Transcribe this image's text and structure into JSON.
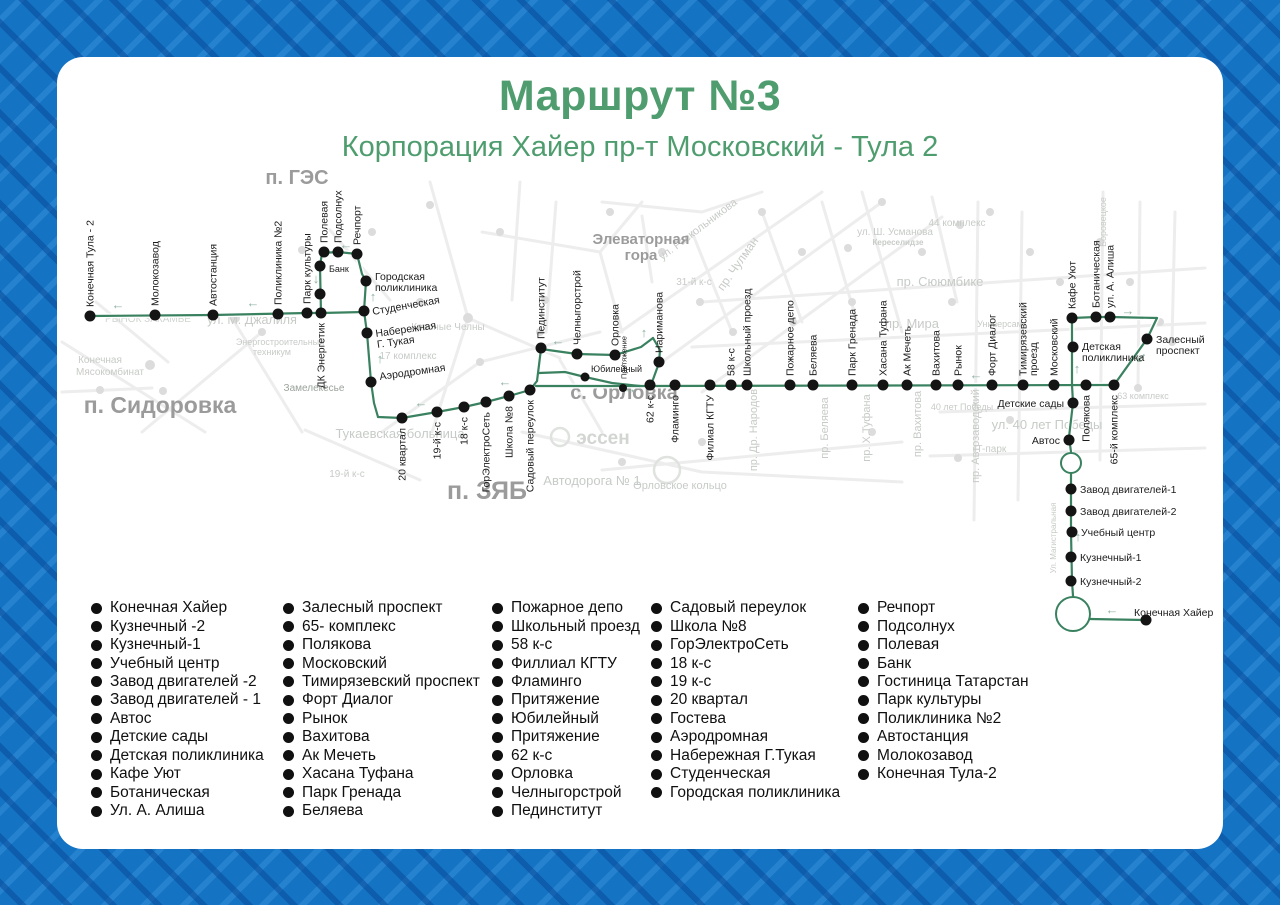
{
  "title": "Маршрут №3",
  "subtitle": "Корпорация Хайер пр-т Московский - Тула 2",
  "colors": {
    "accent_green": "#4f9d6f",
    "route_green": "#3a8160",
    "arrow_green": "#8fb3a1",
    "stop_dot": "#141414",
    "stop_label": "#1c1c1c",
    "area_gray": "#9b9b9b",
    "faint_gray": "#c7cbc7",
    "road_gray": "#ededed",
    "border_blue": "#1573c4",
    "card_bg": "#ffffff",
    "legend_text": "#101010"
  },
  "map": {
    "area_labels": [
      {
        "t": "п. ГЭС",
        "x": 297,
        "y": 184,
        "s": 20
      },
      {
        "t": "п. Сидоровка",
        "x": 160,
        "y": 413,
        "s": 23
      },
      {
        "t": "п. ЗЯБ",
        "x": 487,
        "y": 499,
        "s": 25
      },
      {
        "t": "с. Орловка",
        "x": 624,
        "y": 399,
        "s": 20
      },
      {
        "t": "Элеваторная",
        "x": 641,
        "y": 244,
        "s": 15
      },
      {
        "t": "гора",
        "x": 641,
        "y": 260,
        "s": 15
      }
    ],
    "bg_labels": [
      {
        "t": "РЫНОК ЗАКАМЬЕ",
        "x": 148,
        "y": 322,
        "s": 10,
        "c": "#d0d4d0"
      },
      {
        "t": "ул. М. Джалиля",
        "x": 252,
        "y": 324,
        "s": 12.5
      },
      {
        "t": "Конечная",
        "x": 100,
        "y": 363,
        "s": 10
      },
      {
        "t": "Мясокомбинат",
        "x": 110,
        "y": 375,
        "s": 10
      },
      {
        "t": "Энергостроительный",
        "x": 280,
        "y": 345,
        "s": 9
      },
      {
        "t": "техникум",
        "x": 272,
        "y": 355,
        "s": 9
      },
      {
        "t": "Замелекесье",
        "x": 314,
        "y": 391,
        "s": 10,
        "c": "#9aa29a"
      },
      {
        "t": "17 комплекс",
        "x": 408,
        "y": 359,
        "s": 10
      },
      {
        "t": "Красные Челны",
        "x": 448,
        "y": 330,
        "s": 10
      },
      {
        "t": "Тукаевская больница",
        "x": 400,
        "y": 438,
        "s": 13
      },
      {
        "t": "19-й к-с",
        "x": 347,
        "y": 477,
        "s": 10
      },
      {
        "t": "Автодорога № 1",
        "x": 592,
        "y": 485,
        "s": 13
      },
      {
        "t": "Орловское кольцо",
        "x": 680,
        "y": 489,
        "s": 11
      },
      {
        "t": "эссен",
        "x": 603,
        "y": 444,
        "s": 19,
        "c": "#d2d5d2",
        "b": 1
      },
      {
        "t": "31-й к-с",
        "x": 694,
        "y": 285,
        "s": 10
      },
      {
        "t": "ул. Раскольникова",
        "x": 700,
        "y": 232,
        "s": 11,
        "rot": -37
      },
      {
        "t": "пр. Чулман",
        "x": 741,
        "y": 266,
        "s": 12,
        "rot": -55
      },
      {
        "t": "ул. Ш. Усманова",
        "x": 895,
        "y": 235,
        "s": 10
      },
      {
        "t": "Кереселидзе",
        "x": 898,
        "y": 245,
        "s": 8,
        "b": 1
      },
      {
        "t": "44 комплекс",
        "x": 957,
        "y": 226,
        "s": 10
      },
      {
        "t": "пр. Сююмбике",
        "x": 940,
        "y": 286,
        "s": 13
      },
      {
        "t": "пр. Мира",
        "x": 912,
        "y": 328,
        "s": 13
      },
      {
        "t": "Боровецкое",
        "x": 1106,
        "y": 222,
        "s": 9,
        "vert": 1
      },
      {
        "t": "пр. Др. Народов",
        "x": 757,
        "y": 430,
        "s": 11,
        "vert": 1
      },
      {
        "t": "пр. Беляева",
        "x": 828,
        "y": 428,
        "s": 11,
        "vert": 1
      },
      {
        "t": "пр. Х.Туфана",
        "x": 870,
        "y": 428,
        "s": 11,
        "vert": 1
      },
      {
        "t": "пр. Вахитова",
        "x": 921,
        "y": 424,
        "s": 11,
        "vert": 1
      },
      {
        "t": "пр. Автозаводский",
        "x": 979,
        "y": 436,
        "s": 11,
        "vert": 1
      },
      {
        "t": "ул. 40 лет Победы",
        "x": 1047,
        "y": 429,
        "s": 13
      },
      {
        "t": "40 лет Победы",
        "x": 962,
        "y": 410,
        "s": 9
      },
      {
        "t": "IT-парк",
        "x": 990,
        "y": 452,
        "s": 10
      },
      {
        "t": "Универсам",
        "x": 1000,
        "y": 327,
        "s": 9
      },
      {
        "t": "63 комплекс",
        "x": 1143,
        "y": 399,
        "s": 9
      },
      {
        "t": "Ул. Магистральная",
        "x": 1056,
        "y": 538,
        "s": 8,
        "vert": 1
      }
    ],
    "route_lines": [
      [
        [
          90,
          316
        ],
        [
          213,
          315
        ],
        [
          307,
          313
        ],
        [
          321,
          313
        ],
        [
          364,
          312
        ]
      ],
      [
        [
          321,
          314
        ],
        [
          320,
          266
        ],
        [
          322,
          253
        ],
        [
          338,
          252
        ],
        [
          357,
          254
        ]
      ],
      [
        [
          357,
          254
        ],
        [
          362,
          274
        ],
        [
          366,
          281
        ],
        [
          364,
          311
        ],
        [
          367,
          333
        ],
        [
          371,
          382
        ],
        [
          374,
          403
        ],
        [
          378,
          417
        ]
      ],
      [
        [
          378,
          417
        ],
        [
          402,
          418
        ],
        [
          437,
          412
        ],
        [
          464,
          407
        ],
        [
          486,
          402
        ],
        [
          509,
          396
        ],
        [
          530,
          390
        ],
        [
          537,
          381
        ]
      ],
      [
        [
          537,
          381
        ],
        [
          541,
          349
        ]
      ],
      [
        [
          541,
          349
        ],
        [
          577,
          354
        ],
        [
          615,
          355
        ],
        [
          641,
          347
        ],
        [
          653,
          338
        ]
      ],
      [
        [
          653,
          338
        ],
        [
          660,
          350
        ],
        [
          659,
          363
        ],
        [
          651,
          385
        ]
      ],
      [
        [
          536,
          386
        ],
        [
          650,
          386
        ],
        [
          1114,
          385
        ]
      ],
      [
        [
          539,
          373
        ],
        [
          565,
          372
        ],
        [
          585,
          377
        ],
        [
          612,
          383
        ],
        [
          640,
          386
        ]
      ],
      [
        [
          1072,
          318
        ],
        [
          1072,
          385
        ]
      ],
      [
        [
          1072,
          385
        ],
        [
          1073,
          403
        ],
        [
          1069,
          437
        ],
        [
          1071,
          452
        ]
      ],
      [
        [
          1071,
          474
        ],
        [
          1071,
          532
        ],
        [
          1072,
          581
        ],
        [
          1073,
          596
        ]
      ],
      [
        [
          1072,
          318
        ],
        [
          1096,
          317
        ],
        [
          1110,
          317
        ],
        [
          1157,
          318
        ]
      ],
      [
        [
          1157,
          318
        ],
        [
          1147,
          339
        ],
        [
          1114,
          385
        ]
      ],
      [
        [
          1090,
          619
        ],
        [
          1146,
          620
        ]
      ]
    ],
    "roundabouts": [
      {
        "x": 1071,
        "y": 463,
        "r": 10
      },
      {
        "x": 1073,
        "y": 614,
        "r": 17
      }
    ],
    "arrows": [
      {
        "g": "←",
        "x": 118,
        "y": 309
      },
      {
        "g": "←",
        "x": 253,
        "y": 307
      },
      {
        "g": "↓",
        "x": 316,
        "y": 283
      },
      {
        "g": "←",
        "x": 346,
        "y": 249
      },
      {
        "g": "↑",
        "x": 373,
        "y": 301
      },
      {
        "g": "↑",
        "x": 380,
        "y": 363
      },
      {
        "g": "←",
        "x": 421,
        "y": 407
      },
      {
        "g": "←",
        "x": 505,
        "y": 386
      },
      {
        "g": "←",
        "x": 558,
        "y": 345
      },
      {
        "g": "↑",
        "x": 644,
        "y": 337
      },
      {
        "g": "→",
        "x": 630,
        "y": 393
      },
      {
        "g": "←",
        "x": 976,
        "y": 379
      },
      {
        "g": "→",
        "x": 1128,
        "y": 315
      },
      {
        "g": "↙",
        "x": 1141,
        "y": 362
      },
      {
        "g": "↑",
        "x": 1077,
        "y": 373
      },
      {
        "g": "↑",
        "x": 1078,
        "y": 541
      },
      {
        "g": "←",
        "x": 1112,
        "y": 614
      }
    ],
    "stops": [
      {
        "n": "Конечная Тула - 2",
        "x": 90,
        "y": 316,
        "m": "v"
      },
      {
        "n": "Молокозавод",
        "x": 155,
        "y": 315,
        "m": "v"
      },
      {
        "n": "Автостанция",
        "x": 213,
        "y": 315,
        "m": "v"
      },
      {
        "n": "Поликлиника №2",
        "x": 278,
        "y": 314,
        "m": "v"
      },
      {
        "n": "Парк культуры",
        "x": 307,
        "y": 313,
        "m": "v"
      },
      {
        "n": "ДК Энергетик",
        "x": 321,
        "y": 313,
        "m": "vb"
      },
      {
        "n": "Банк",
        "x": 320,
        "y": 266,
        "m": "r",
        "s": 9,
        "dy": 2
      },
      {
        "n": "",
        "x": 320,
        "y": 294,
        "m": "none"
      },
      {
        "n": "Полевая",
        "x": 324,
        "y": 252,
        "m": "v"
      },
      {
        "n": "Подсолнух",
        "x": 338,
        "y": 252,
        "m": "v"
      },
      {
        "n": "Речпорт",
        "x": 357,
        "y": 254,
        "m": "v"
      },
      {
        "n": "Городская\nполиклиника",
        "x": 366,
        "y": 281,
        "m": "r",
        "dy": -5
      },
      {
        "n": "Студенческая",
        "x": 364,
        "y": 311,
        "m": "r",
        "rot": -10
      },
      {
        "n": "Набережная\nГ. Тукая",
        "x": 367,
        "y": 333,
        "m": "r",
        "rot": -8
      },
      {
        "n": "Аэродромная",
        "x": 371,
        "y": 382,
        "m": "r",
        "dy": -6,
        "rot": -8
      },
      {
        "n": "20 квартал",
        "x": 402,
        "y": 418,
        "m": "vb"
      },
      {
        "n": "19-й к-с",
        "x": 437,
        "y": 412,
        "m": "vb"
      },
      {
        "n": "18 к-с",
        "x": 464,
        "y": 407,
        "m": "vb"
      },
      {
        "n": "ГорЭлектроСеть",
        "x": 486,
        "y": 402,
        "m": "vb"
      },
      {
        "n": "Школа №8",
        "x": 509,
        "y": 396,
        "m": "vb"
      },
      {
        "n": "Садовый переулок",
        "x": 530,
        "y": 390,
        "m": "vb"
      },
      {
        "n": "Пединститут",
        "x": 541,
        "y": 348,
        "m": "v"
      },
      {
        "n": "Челныгорстрой",
        "x": 577,
        "y": 354,
        "m": "v"
      },
      {
        "n": "Орловка",
        "x": 615,
        "y": 355,
        "m": "v"
      },
      {
        "n": "Нариманова",
        "x": 659,
        "y": 362,
        "m": "v"
      },
      {
        "n": "Юбилейный",
        "x": 585,
        "y": 377,
        "m": "r",
        "s": 9,
        "dx": -3,
        "dy": -9,
        "r": 4.5
      },
      {
        "n": "Притяжение",
        "x": 623,
        "y": 388,
        "m": "v",
        "s": 7.5,
        "r": 4
      },
      {
        "n": "62 к-с",
        "x": 650,
        "y": 385,
        "m": "vb"
      },
      {
        "n": "Фламинго",
        "x": 675,
        "y": 385,
        "m": "vb"
      },
      {
        "n": "Филиал КГТУ",
        "x": 710,
        "y": 385,
        "m": "vb"
      },
      {
        "n": "58 к-с",
        "x": 731,
        "y": 385,
        "m": "v"
      },
      {
        "n": "Школьный проезд",
        "x": 747,
        "y": 385,
        "m": "v"
      },
      {
        "n": "Пожарное депо",
        "x": 790,
        "y": 385,
        "m": "v"
      },
      {
        "n": "Беляева",
        "x": 813,
        "y": 385,
        "m": "v"
      },
      {
        "n": "Парк Гренада",
        "x": 852,
        "y": 385,
        "m": "v"
      },
      {
        "n": "Хасана Туфана",
        "x": 883,
        "y": 385,
        "m": "v"
      },
      {
        "n": "Ак Мечеть",
        "x": 907,
        "y": 385,
        "m": "v"
      },
      {
        "n": "Вахитова",
        "x": 936,
        "y": 385,
        "m": "v"
      },
      {
        "n": "Рынок",
        "x": 958,
        "y": 385,
        "m": "v"
      },
      {
        "n": "Форт Диалог",
        "x": 992,
        "y": 385,
        "m": "v"
      },
      {
        "n": "Тимирязевский\nпроезд",
        "x": 1023,
        "y": 385,
        "m": "v"
      },
      {
        "n": "Московский",
        "x": 1054,
        "y": 385,
        "m": "v"
      },
      {
        "n": "Полякова",
        "x": 1086,
        "y": 385,
        "m": "vb"
      },
      {
        "n": "65-й комплекс",
        "x": 1114,
        "y": 385,
        "m": "vb"
      },
      {
        "n": "Кафе Уют",
        "x": 1072,
        "y": 318,
        "m": "v"
      },
      {
        "n": "Ботаническая",
        "x": 1096,
        "y": 317,
        "m": "v"
      },
      {
        "n": "ул. А. Алиша",
        "x": 1110,
        "y": 317,
        "m": "v"
      },
      {
        "n": "Залесный\nпроспект",
        "x": 1147,
        "y": 339,
        "m": "r",
        "dy": 0
      },
      {
        "n": "Детская\nполиклиника",
        "x": 1073,
        "y": 347,
        "m": "r",
        "dy": -1
      },
      {
        "n": "Детские сады",
        "x": 1073,
        "y": 403,
        "m": "l"
      },
      {
        "n": "Автос",
        "x": 1069,
        "y": 440,
        "m": "l"
      },
      {
        "n": "Завод двигателей-1",
        "x": 1071,
        "y": 489,
        "m": "r"
      },
      {
        "n": "Завод двигателей-2",
        "x": 1071,
        "y": 511,
        "m": "r"
      },
      {
        "n": "Учебный центр",
        "x": 1072,
        "y": 532,
        "m": "r"
      },
      {
        "n": "Кузнечный-1",
        "x": 1071,
        "y": 557,
        "m": "r"
      },
      {
        "n": "Кузнечный-2",
        "x": 1071,
        "y": 581,
        "m": "r"
      },
      {
        "n": "Конечная Хайер",
        "x": 1146,
        "y": 620,
        "m": "r",
        "dx": -21,
        "dy": -8
      }
    ]
  },
  "legend": {
    "columns": [
      {
        "items": [
          "Конечная Хайер",
          "Кузнечный -2",
          "Кузнечный-1",
          "Учебный центр",
          "Завод двигателей -2",
          "Завод двигателей - 1",
          "Автос",
          "Детские сады",
          "Детская поликлиника",
          "Кафе Уют",
          "Ботаническая",
          "Ул. А. Алиша"
        ]
      },
      {
        "items": [
          "Залесный проспект",
          "65- комплекс",
          "Полякова",
          "Московский",
          "Тимирязевский проспект",
          "Форт Диалог",
          "Рынок",
          "Вахитова",
          "Ак Мечеть",
          "Хасана Туфана",
          "Парк Гренада",
          "Беляева"
        ]
      },
      {
        "items": [
          "Пожарное депо",
          "Школьный проезд",
          "58 к-с",
          "Филлиал КГТУ",
          "Фламинго",
          "Притяжение",
          "Юбилейный",
          "Притяжение",
          "62 к-с",
          "Орловка",
          "Челныгорстрой",
          "Пединститут"
        ]
      },
      {
        "items": [
          "Садовый переулок",
          "Школа №8",
          "ГорЭлектроСеть",
          "18 к-с",
          "19 к-с",
          "20 квартал",
          "Гостева",
          "Аэродромная",
          "Набережная Г.Тукая",
          "Студенческая",
          "Городская поликлиника"
        ]
      },
      {
        "items": [
          "Речпорт",
          "Подсолнух",
          "Полевая",
          "Банк",
          "Гостиница Татарстан",
          "Парк культуры",
          "Поликлиника №2",
          "Автостанция",
          "Молокозавод",
          "Конечная Тула-2"
        ]
      }
    ]
  }
}
